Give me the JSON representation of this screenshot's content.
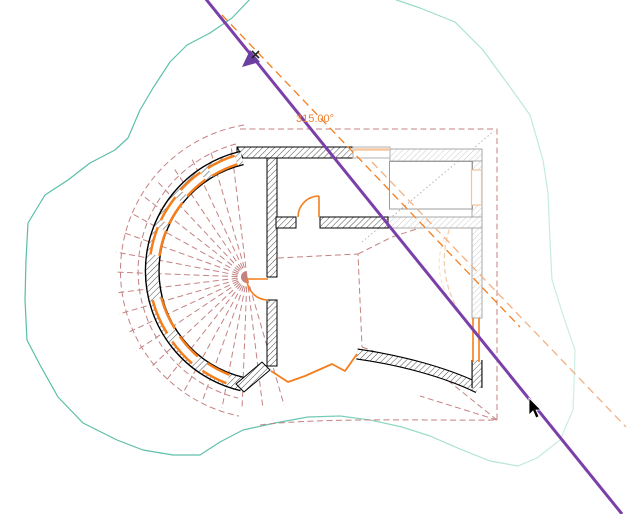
{
  "app": {
    "name": "cad-plan-rotate-view",
    "canvas_width": 626,
    "canvas_height": 514
  },
  "annotation": {
    "angle_label": "315.00°"
  },
  "colors": {
    "rotation_line": "#7a3fa8",
    "highlight_orange": "#f57e1c",
    "pale_orange_ghost": "#f2b082",
    "peach_ghost": "#f3cba4",
    "rose_dashed_overlay": "#c48282",
    "topo_teal_dark": "#58bda6",
    "topo_teal_pale": "#cfeee4",
    "ghost_wall_gray": "#a8a8a8",
    "wall_black": "#000000",
    "hatch_dark": "#4a4a4a",
    "hatch_light": "#cccccc"
  },
  "paths": {
    "topo_contour": "M385,-4 L420,8 L455,22 L483,50 L510,87 L530,115 L543,160 L548,193 L550,240 L552,280 L563,315 L575,350 L574,385 L573,410 L560,440 L537,458 L518,466 L490,461 L460,449 L430,436 L402,427 L370,420 L340,416 L308,417 L275,423 L243,430 L220,442 L200,455 L173,455 L143,450 L117,440 L83,423 L58,397 L40,365 L27,340 L25,300 L26,260 L28,223 L45,195 L68,180 L90,163 L115,150 L128,138 L140,110 L153,88 L170,62 L187,45 L210,33 L232,18 L253,-4",
    "roof_outline": "M240,129 L497,129 L497,420 C455,421 320,417 260,425",
    "roof_ring_outer": "M244,125 A148 148 0 0 0 239,416",
    "roof_ring_inner": "M236,144 A131 131 0 0 0 238,398",
    "fan_spokes": "M247,277L231,145M247,277L210,149M247,277L191,157M247,277L173,167M247,277L156,180M247,277L142,195M247,277L131,213M247,277L122,232M247,277L116,252M247,277L114,272M247,277L115,293M247,277L119,314M247,277L127,333M247,277L136,351M247,277L150,368M247,277L165,382M247,277L183,393M247,277L202,402M247,277L222,408M247,277L242,410M247,277L263,409M247,277L284,405",
    "overlay_extras": "M278,258 L358,254 L362,347 M358,254 L392,237 L438,222 M362,347 L415,366 M497,420 L430,366 M497,420 L420,396",
    "ghost_dotted_diagonal": "M362,242 L494,131",
    "ghost_arc_1": "M452,222 Q434,267 458,310",
    "ghost_arc_2": "M444,238 Q433,267 447,296",
    "pale_orange_dashed": "M372,162 L626,427",
    "main_orange_dashed": "M222,15 L520,327",
    "rotation_line": "M205,-2 L622,514",
    "arc_wall": "M242,158 A116 116 0 0 0 242,384",
    "arc_window_1": "M236,160 A116 116 0 0 0 210,172",
    "arc_window_2": "M203,176 A116 116 0 0 0 184,193",
    "arc_window_3": "M179,200 A116 116 0 0 0 165,222",
    "arc_window_4": "M162,229 A116 116 0 0 0 155,255",
    "arc_window_5": "M157,299 A116 116 0 0 0 171,331",
    "arc_window_6": "M176,339 A116 116 0 0 0 195,360",
    "arc_window_7": "M205,367 A116 116 0 0 0 228,379",
    "bottom_wall_band": "M357,354 C400,360 445,372 478,388",
    "right_wall_black_piece": "M477,360 L477,388",
    "wavy_wall_line": "M271,371 L288,382 L305,376 L332,364 L345,371 L357,354",
    "door_upper": "M298,217 A21 21 0 0 1 319,196 M319,196 L319,217",
    "door_center": "M247,279 L268,279 M247,279 A21 21 0 0 0 268,300",
    "right_window_orange": "M473,318 L473,362 M479,318 L479,362",
    "top_wall_corner_tick": "M237,147 L243,158",
    "peach_window_top_line": "M354,149.5 L389,149.5",
    "diag_wall_polygon_points": "236,384 262,362 270,370 244,392",
    "rotate_cursor_triangle_points": "242,67 250,50 260,62",
    "rotate_cursor_x": "M252,51 L259,58 M259,51 L252,58",
    "pointer_cursor_points": "529,398 529,415 533,411 536,418 539,416.5 536,410 541,410"
  }
}
